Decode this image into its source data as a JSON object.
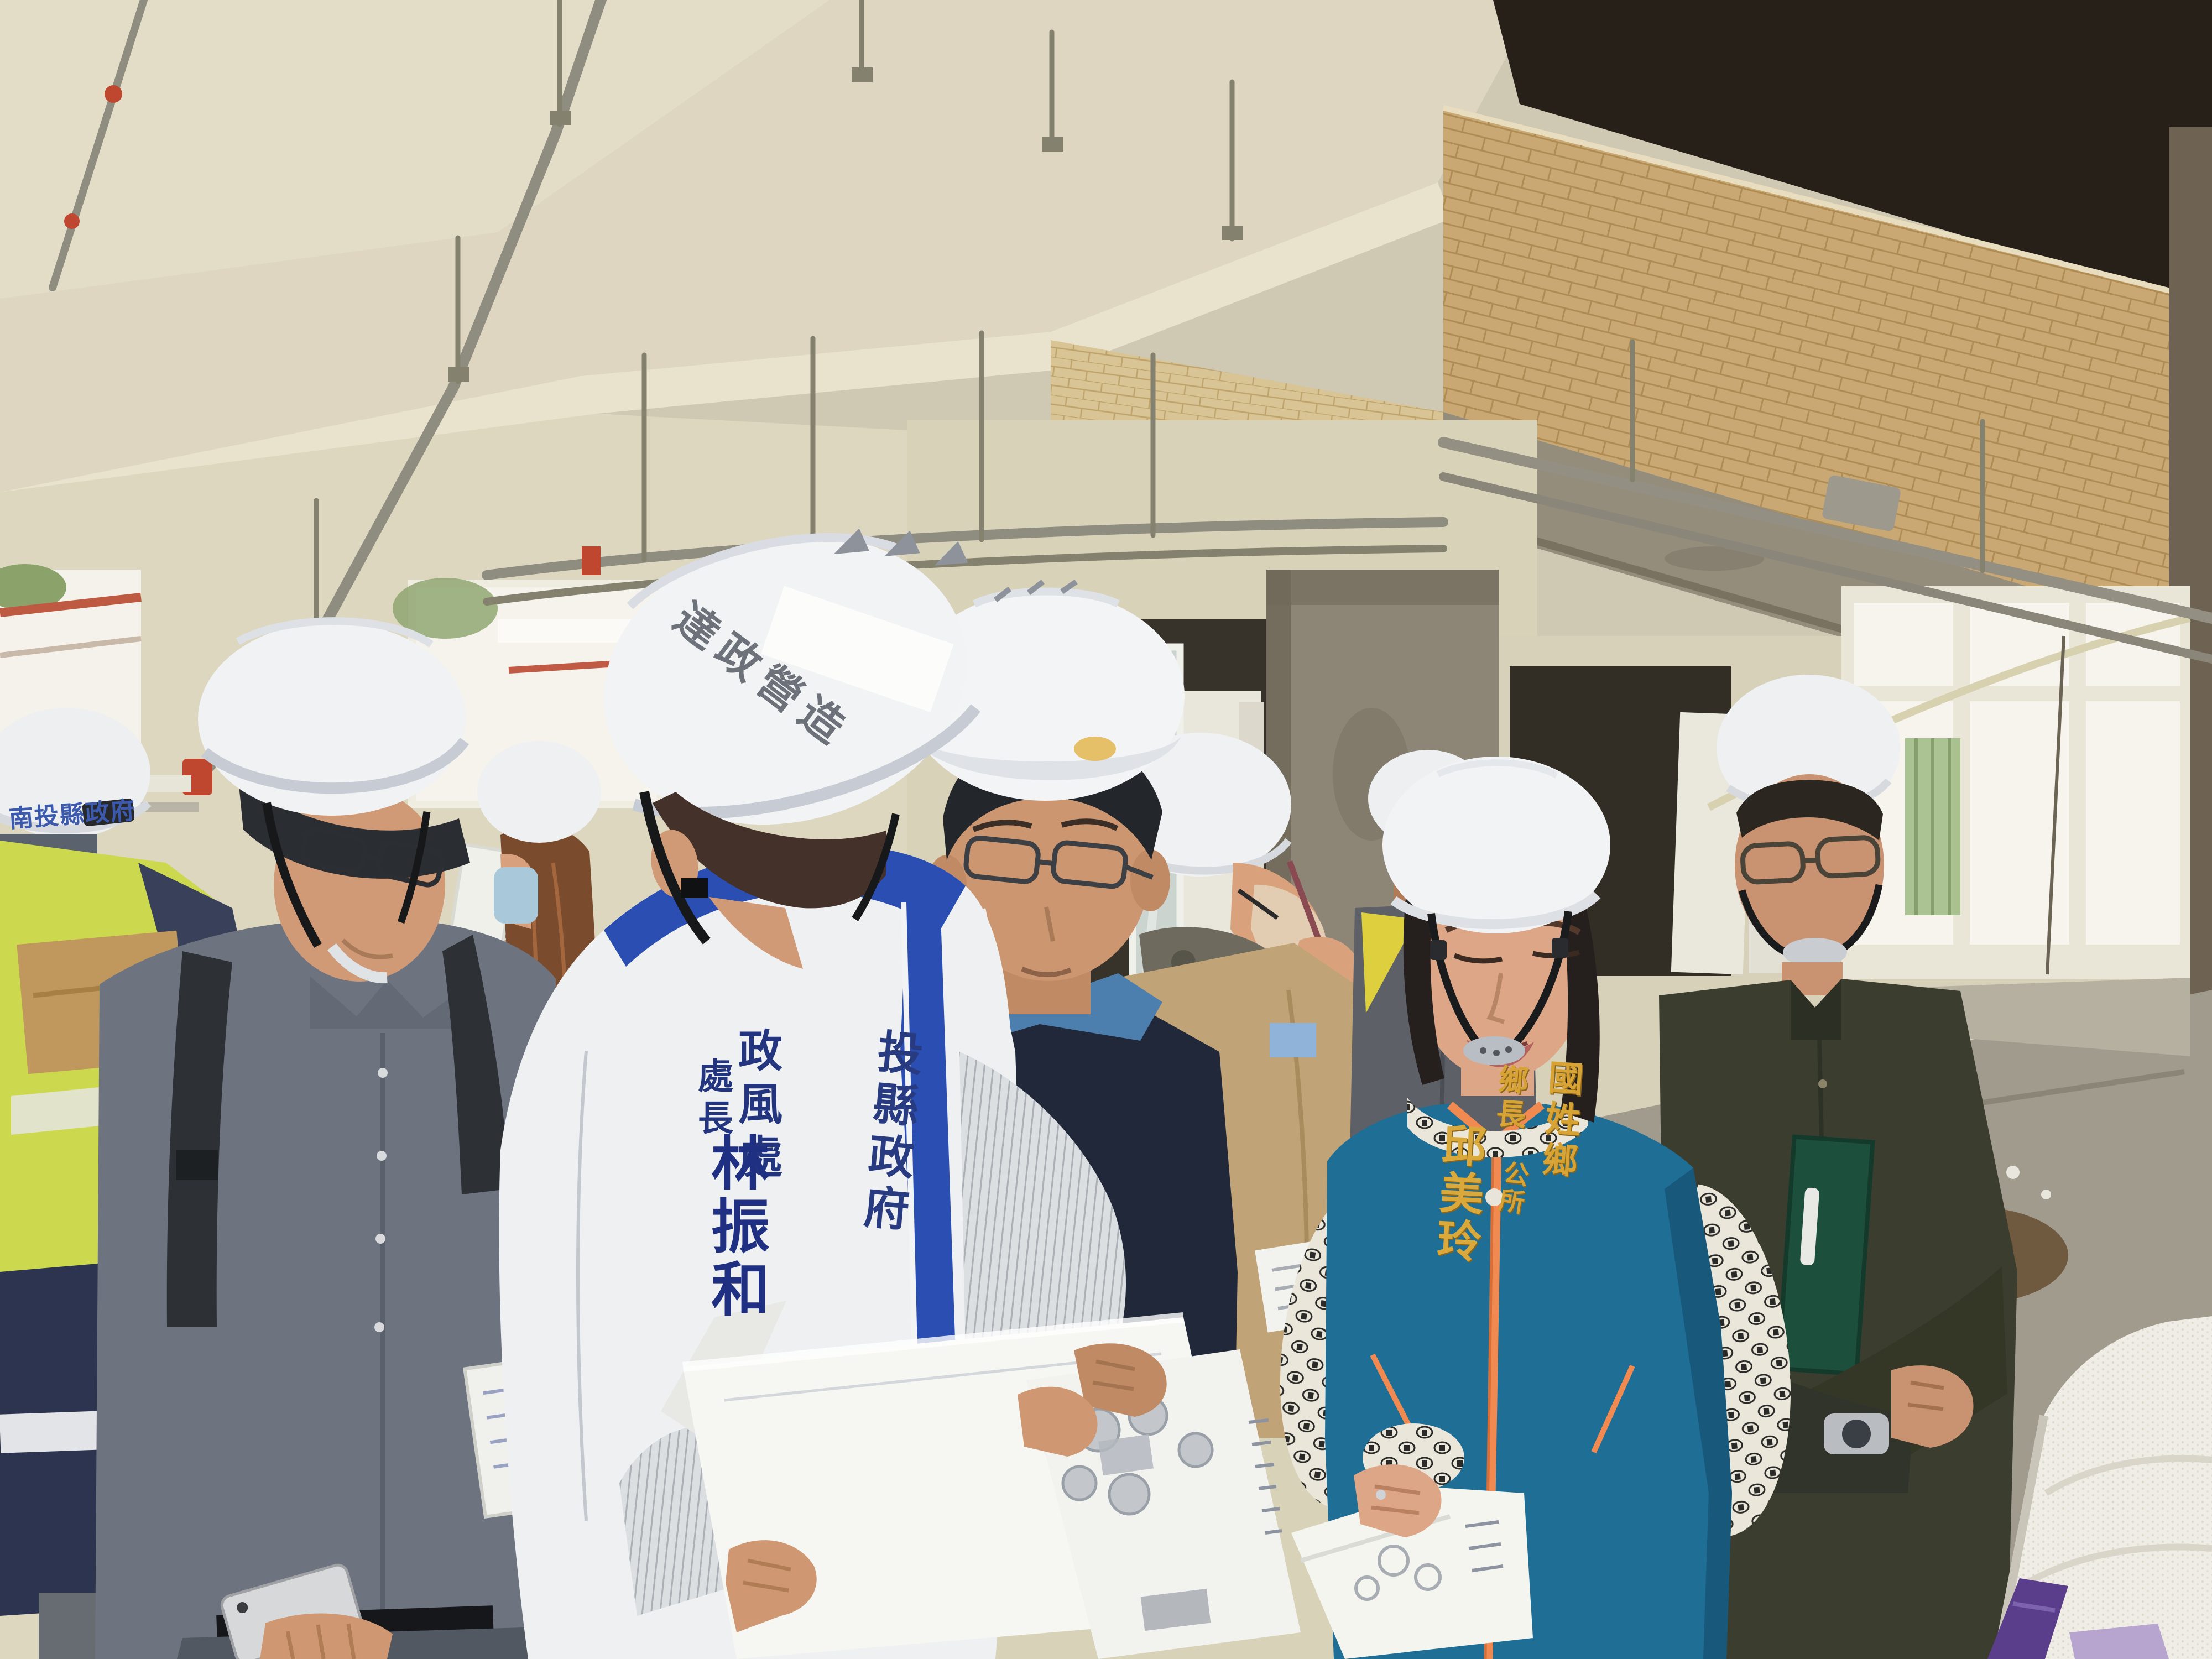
{
  "scene": {
    "title": "Construction site inspection walkthrough",
    "setting": "Unfinished reinforced-concrete building interior: cream ceiling with hanging conduit, tan tile band, bare concrete columns and beams, bright window openings, gray screed floor",
    "people_count_visible": 10
  },
  "labels": {
    "contractor_helmet_text": "達政營造",
    "county_helmet_text": "南投縣政府",
    "lead_official_vest": {
      "department": "政風處",
      "title": "處長",
      "name": "林振和",
      "agency_panel_visible": "投縣政府"
    },
    "mayor_vest": {
      "township": "國姓鄉",
      "office": "公所",
      "title": "鄉長",
      "name": "邱美玲"
    }
  },
  "colors": {
    "vest_trim_blue": "#2a4eb2",
    "vest_text_navy": "#24357f",
    "mayor_vest_teal": "#1e6e95",
    "mayor_zipper_orange": "#f08a50",
    "mayor_text_gold": "#d7a335",
    "hi_vis_green": "#ccd84d",
    "helmet_white": "#f1f3f5",
    "tile_band_tan": "#c9a873",
    "sprinkler_red": "#bf4730"
  },
  "people": [
    {
      "id": "lead-official",
      "note": "white vest with royal-blue trim, white helmet with contractor sticker, reading large documents"
    },
    {
      "id": "blue-shirt-official",
      "note": "blue shirt, navy vest, glasses, white helmet, holding printed site plan"
    },
    {
      "id": "mayor",
      "note": "teal vest with orange zipper, patterned white blouse, white helmet, holding site plan"
    },
    {
      "id": "olive-shirt-man",
      "note": "dark olive shirt, arms crossed with green folder, white helmet, wristwatch"
    },
    {
      "id": "khaki-jacket-man",
      "note": "khaki jacket, face mask, pen in hand, white helmet, facing right"
    },
    {
      "id": "gray-shirt-man",
      "note": "gray shirt, black backpack straps, glasses, white helmet, using phone, notebook under arm"
    },
    {
      "id": "hi-vis-worker",
      "note": "yellow-green safety vest, navy bag, carrying cardboard box and papers"
    },
    {
      "id": "county-staffer",
      "note": "white helmet printed with county government name, holding documents"
    },
    {
      "id": "masked-woman",
      "note": "long brown hair, light blue mask, white helmet, holding white board"
    },
    {
      "id": "jacket-man-background",
      "note": "gray jacket with yellow collar panel, dark sunglasses, white helmet"
    }
  ]
}
